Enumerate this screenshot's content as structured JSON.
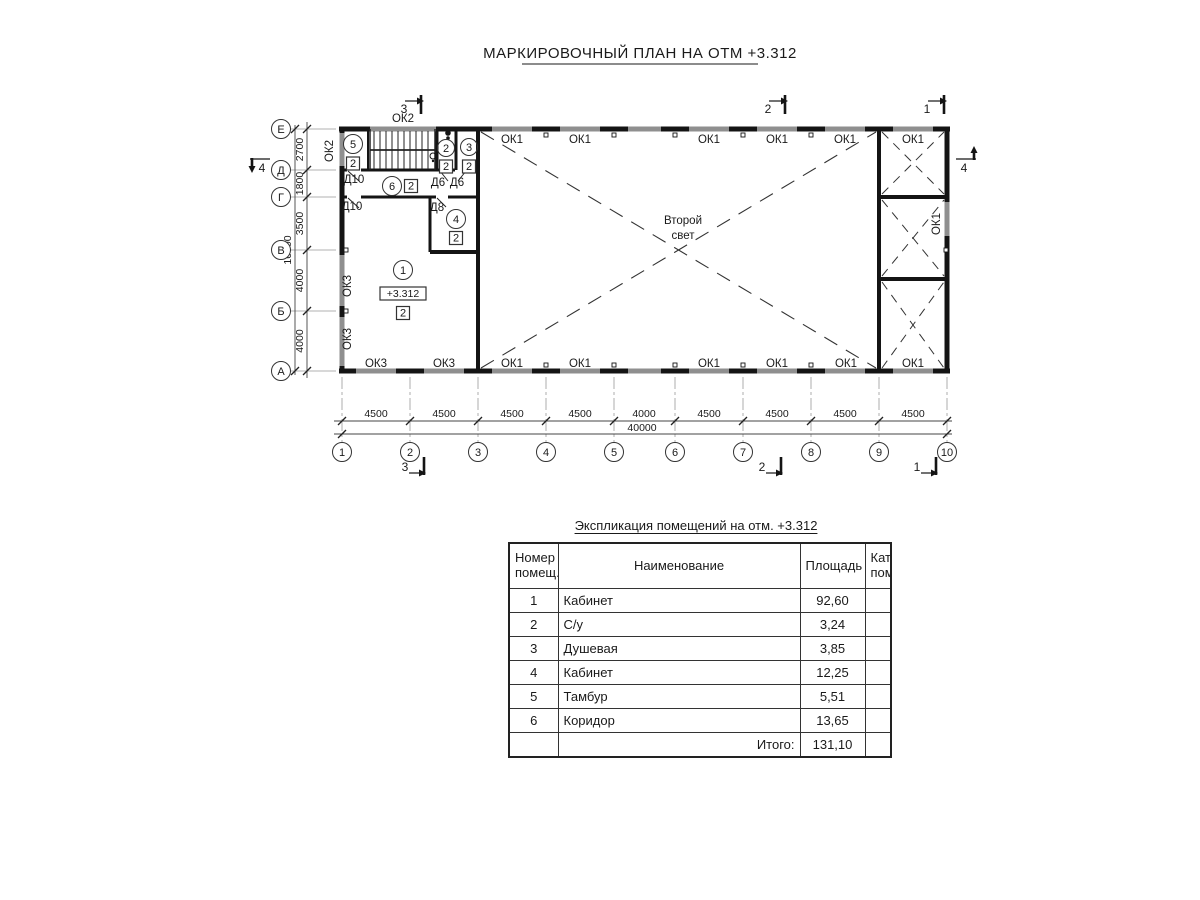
{
  "page_title": "МАРКИРОВОЧНЫЙ ПЛАН НА ОТМ +3.312",
  "plan": {
    "second_light_line1": "Второй",
    "second_light_line2": "свет",
    "elevation_mark": "+3.312",
    "category_mark": "2",
    "windows": {
      "ok1": "ОК1",
      "ok2": "ОК2",
      "ok3": "ОК3"
    },
    "doors": {
      "d10": "Д10",
      "d8": "Д8",
      "d6": "Д6"
    },
    "axes_h": [
      "1",
      "2",
      "3",
      "4",
      "5",
      "6",
      "7",
      "8",
      "9",
      "10"
    ],
    "axes_v": [
      "Е",
      "Д",
      "Г",
      "В",
      "Б",
      "А"
    ],
    "dims_bottom": [
      "4500",
      "4500",
      "4500",
      "4500",
      "4000",
      "4500",
      "4500",
      "4500",
      "4500"
    ],
    "dim_bottom_total": "40000",
    "dims_left": [
      "2700",
      "1800",
      "3500",
      "4000",
      "4000"
    ],
    "dim_left_total": "16000",
    "rooms": [
      "1",
      "2",
      "3",
      "4",
      "5",
      "6"
    ],
    "sections": {
      "s1": "1",
      "s2": "2",
      "s3": "3",
      "s4": "4"
    }
  },
  "table": {
    "title": "Экспликация помещений на отм. +3.312",
    "headers": {
      "num_line1": "Номер",
      "num_line2": "помещ.",
      "name": "Наименование",
      "area": "Площадь",
      "cat_line1": "Кат.",
      "cat_line2": "пом."
    },
    "rows": [
      {
        "num": "1",
        "name": "Кабинет",
        "area": "92,60",
        "cat": ""
      },
      {
        "num": "2",
        "name": "С/у",
        "area": "3,24",
        "cat": ""
      },
      {
        "num": "3",
        "name": "Душевая",
        "area": "3,85",
        "cat": ""
      },
      {
        "num": "4",
        "name": "Кабинет",
        "area": "12,25",
        "cat": ""
      },
      {
        "num": "5",
        "name": "Тамбур",
        "area": "5,51",
        "cat": ""
      },
      {
        "num": "6",
        "name": "Коридор",
        "area": "13,65",
        "cat": ""
      }
    ],
    "total_label": "Итого:",
    "total_area": "131,10"
  }
}
